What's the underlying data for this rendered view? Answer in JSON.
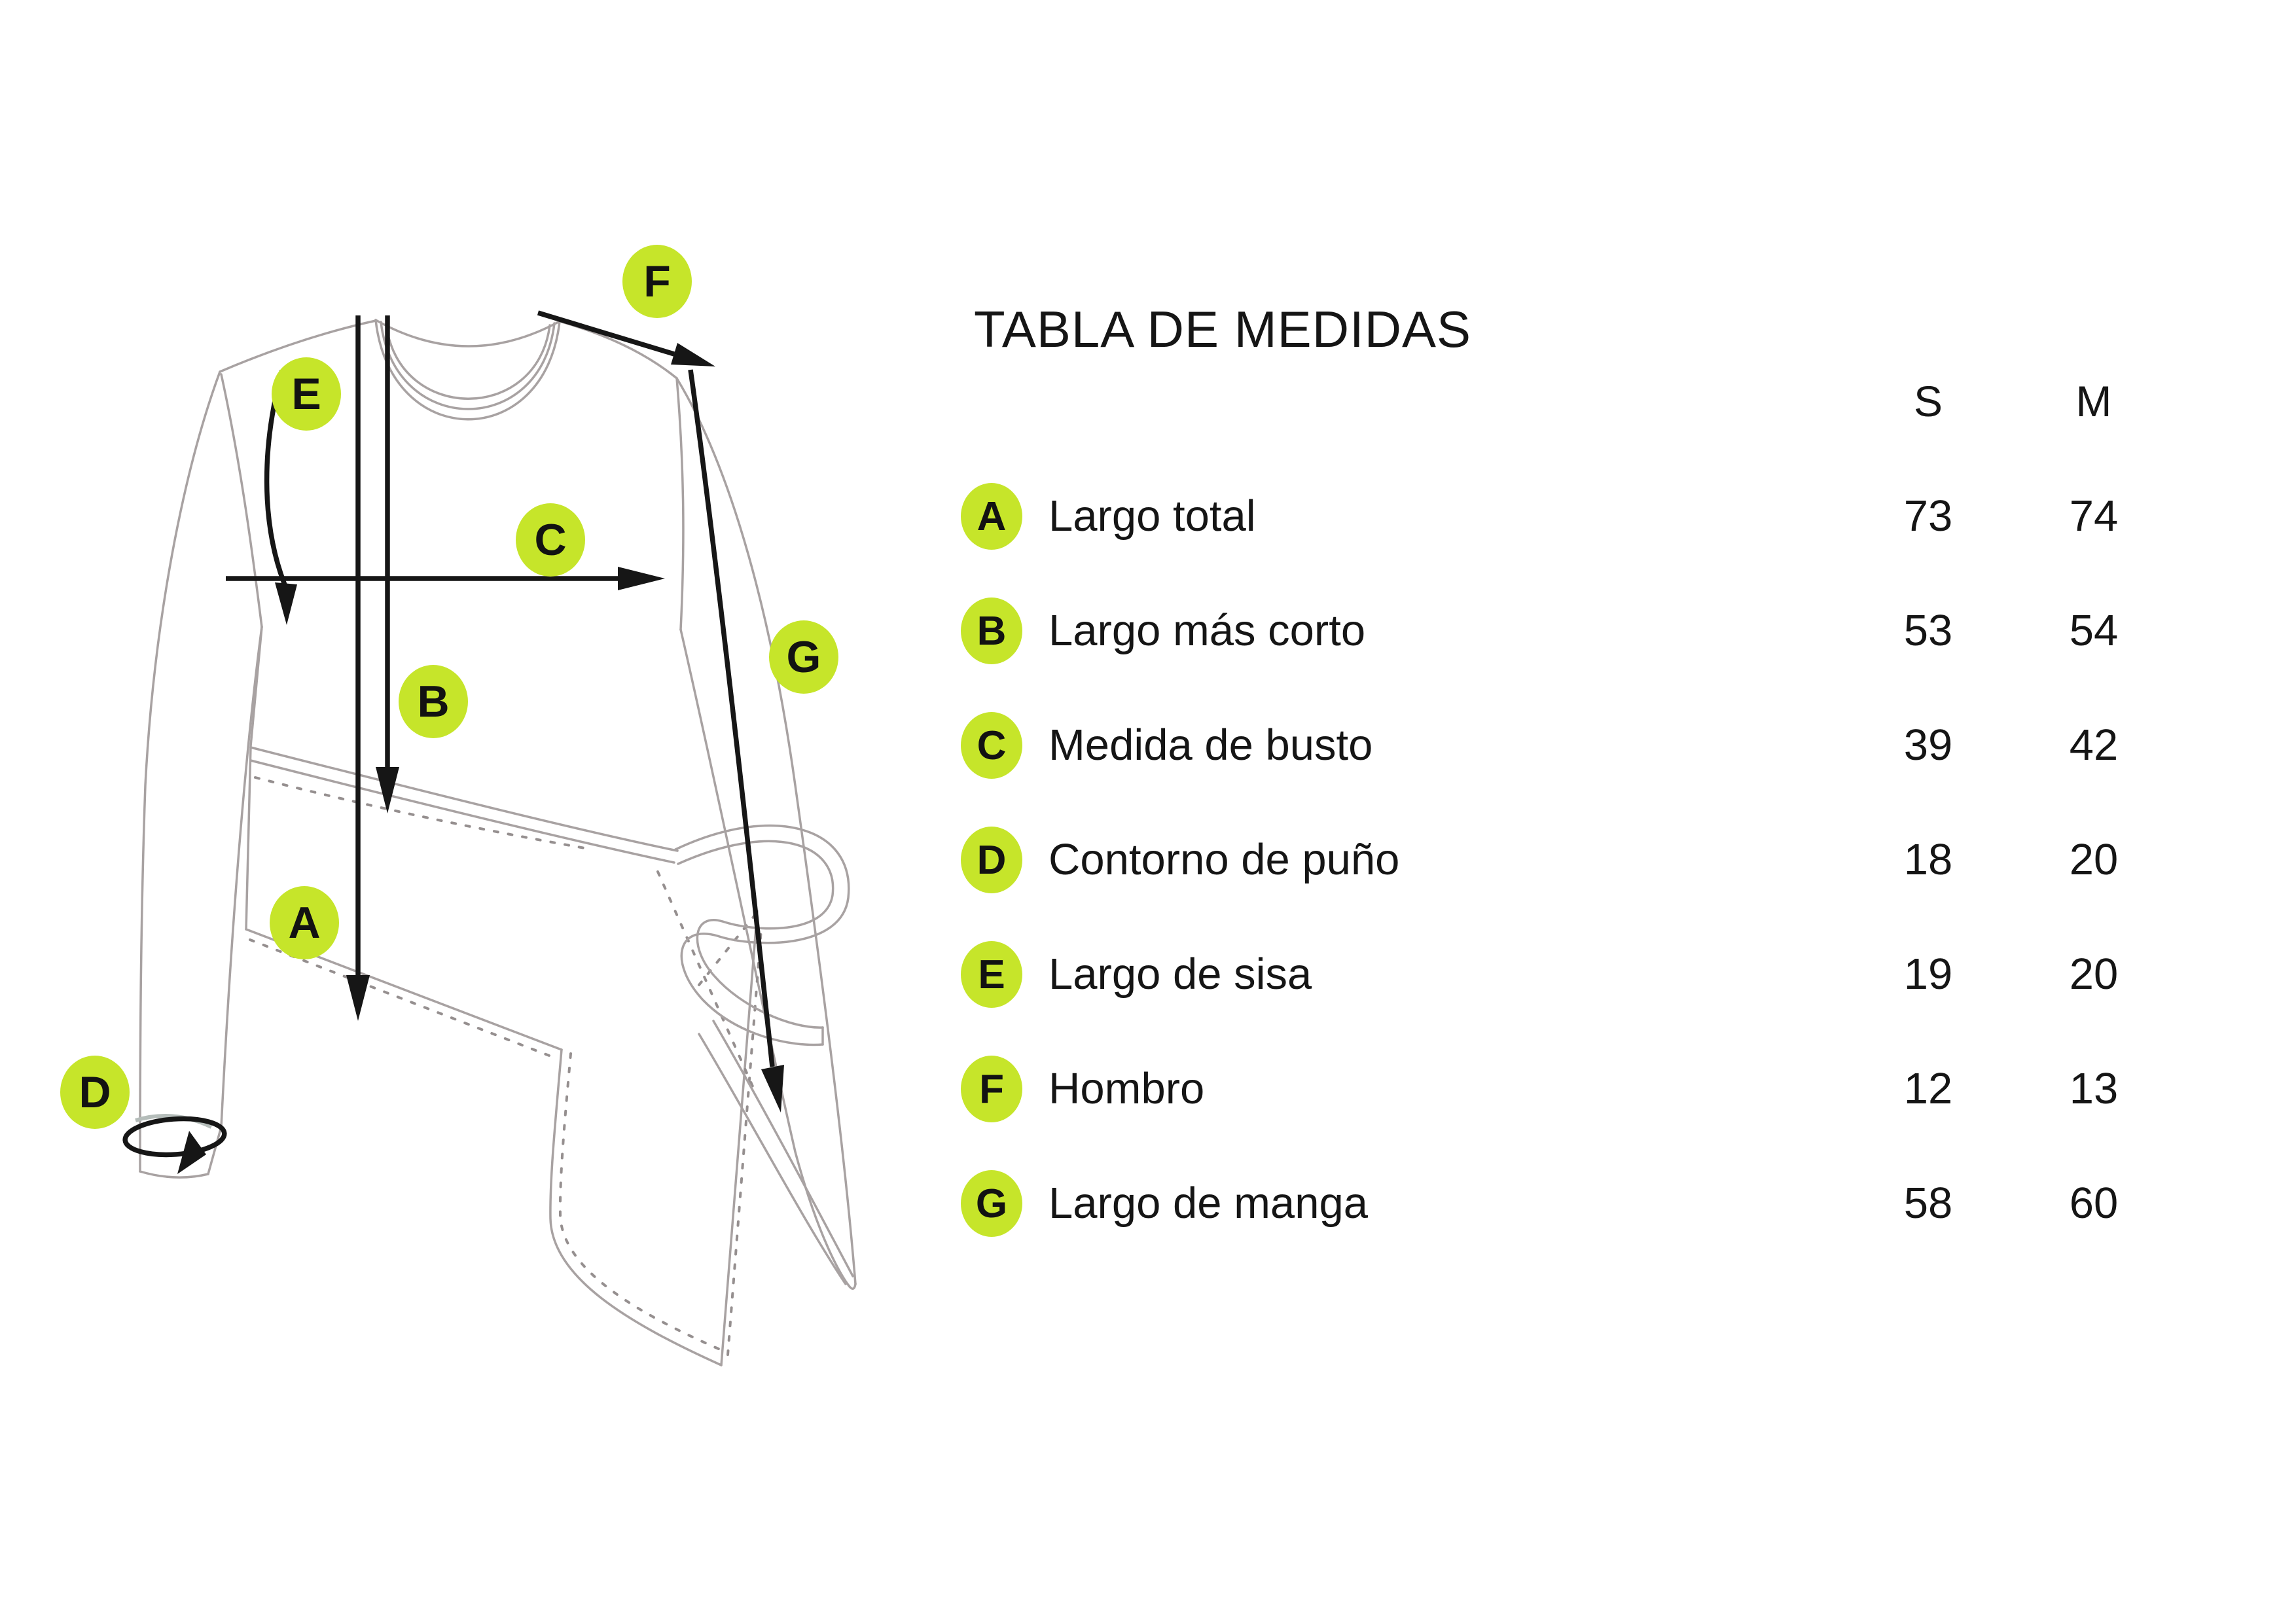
{
  "title": "TABLA DE MEDIDAS",
  "columns": [
    {
      "label": "S"
    },
    {
      "label": "M"
    }
  ],
  "rows": [
    {
      "letter": "A",
      "label": "Largo total",
      "s": "73",
      "m": "74"
    },
    {
      "letter": "B",
      "label": "Largo más corto",
      "s": "53",
      "m": "54"
    },
    {
      "letter": "C",
      "label": "Medida de busto",
      "s": "39",
      "m": "42"
    },
    {
      "letter": "D",
      "label": "Contorno de puño",
      "s": "18",
      "m": "20"
    },
    {
      "letter": "E",
      "label": "Largo de sisa",
      "s": "19",
      "m": "20"
    },
    {
      "letter": "F",
      "label": "Hombro",
      "s": "12",
      "m": "13"
    },
    {
      "letter": "G",
      "label": "Largo de manga",
      "s": "58",
      "m": "60"
    }
  ],
  "colors": {
    "accent_green": "#c6e52a",
    "sketch_line_gray": "#a8a2a2",
    "annotation_ink": "#161616"
  }
}
